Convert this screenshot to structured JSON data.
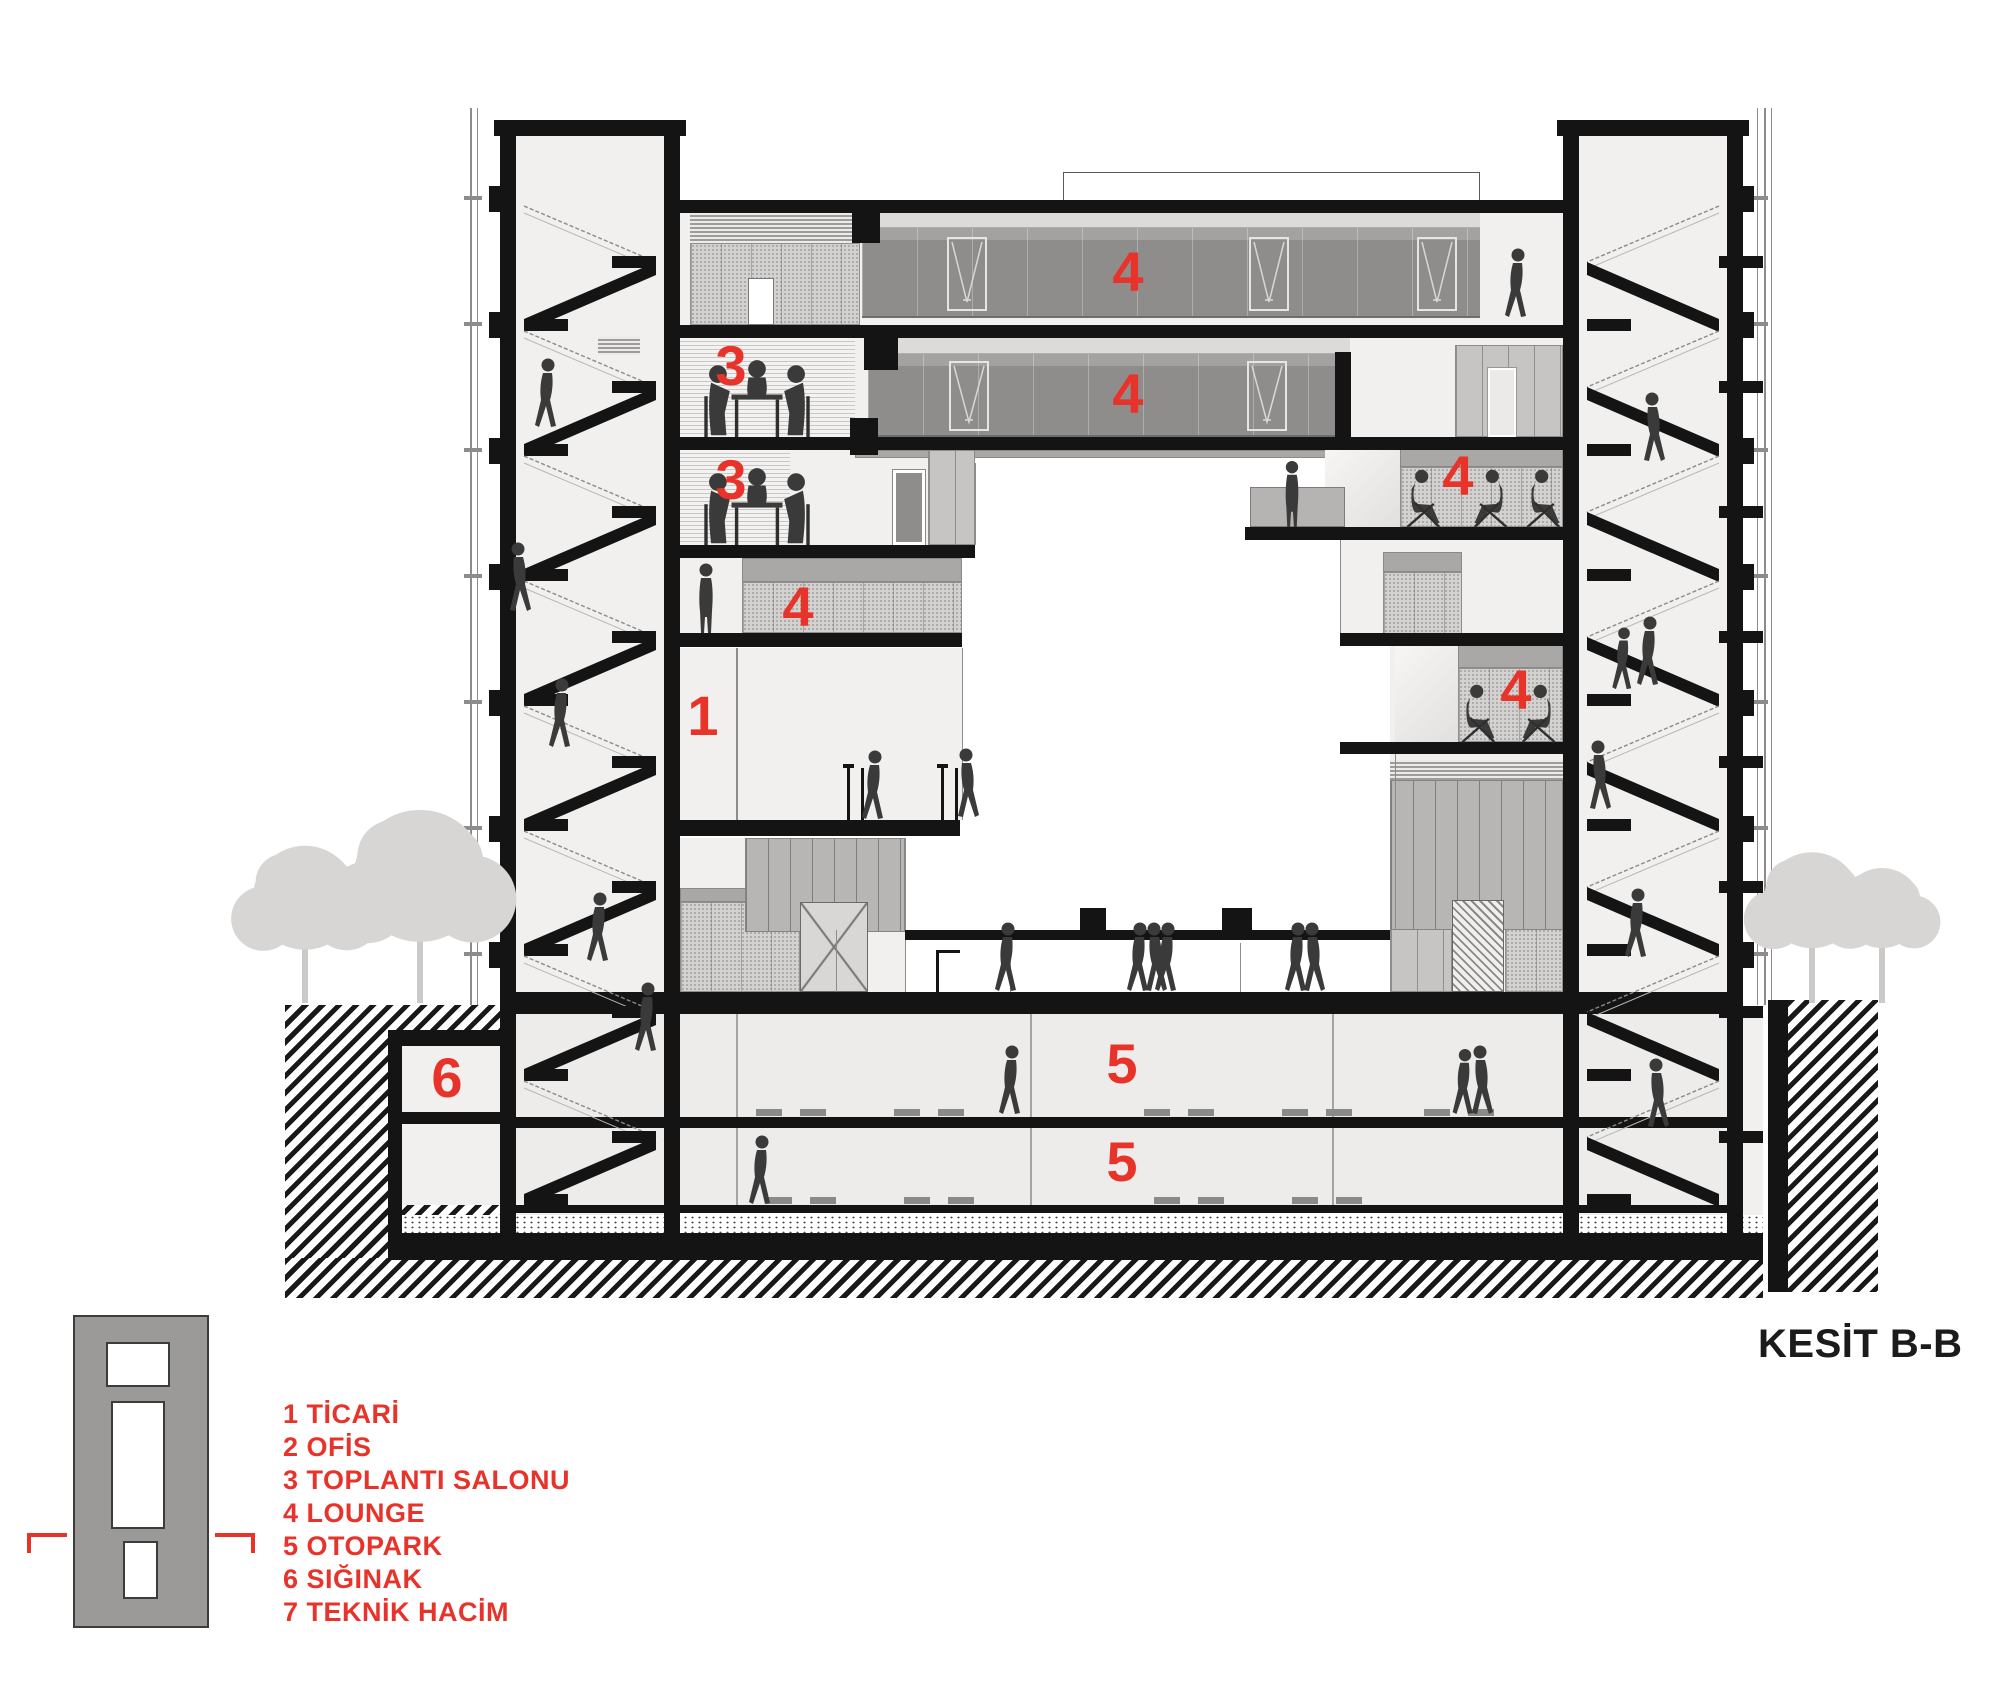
{
  "title": "KESİT B-B",
  "drawing": {
    "type": "architectural-section",
    "name": "Kesit B-B (Section B-B)"
  },
  "legend": {
    "items": [
      "1 TİCARİ",
      "2 OFİS",
      "3 TOPLANTI SALONU",
      "4 LOUNGE",
      "5 OTOPARK",
      "6 SIĞINAK",
      "7 TEKNİK HACİM"
    ]
  },
  "section_labels": [
    {
      "text": "4",
      "x": 1128,
      "y": 272
    },
    {
      "text": "3",
      "x": 731,
      "y": 366
    },
    {
      "text": "4",
      "x": 1128,
      "y": 394
    },
    {
      "text": "3",
      "x": 731,
      "y": 480
    },
    {
      "text": "4",
      "x": 1458,
      "y": 476
    },
    {
      "text": "4",
      "x": 798,
      "y": 607
    },
    {
      "text": "1",
      "x": 703,
      "y": 716
    },
    {
      "text": "4",
      "x": 1516,
      "y": 690
    },
    {
      "text": "6",
      "x": 447,
      "y": 1078
    },
    {
      "text": "5",
      "x": 1122,
      "y": 1064
    },
    {
      "text": "5",
      "x": 1122,
      "y": 1162
    }
  ],
  "colors": {
    "accent": "#e8332a",
    "ink": "#141414",
    "people": "#3a3a3a",
    "tree": "#d7d6d4"
  }
}
